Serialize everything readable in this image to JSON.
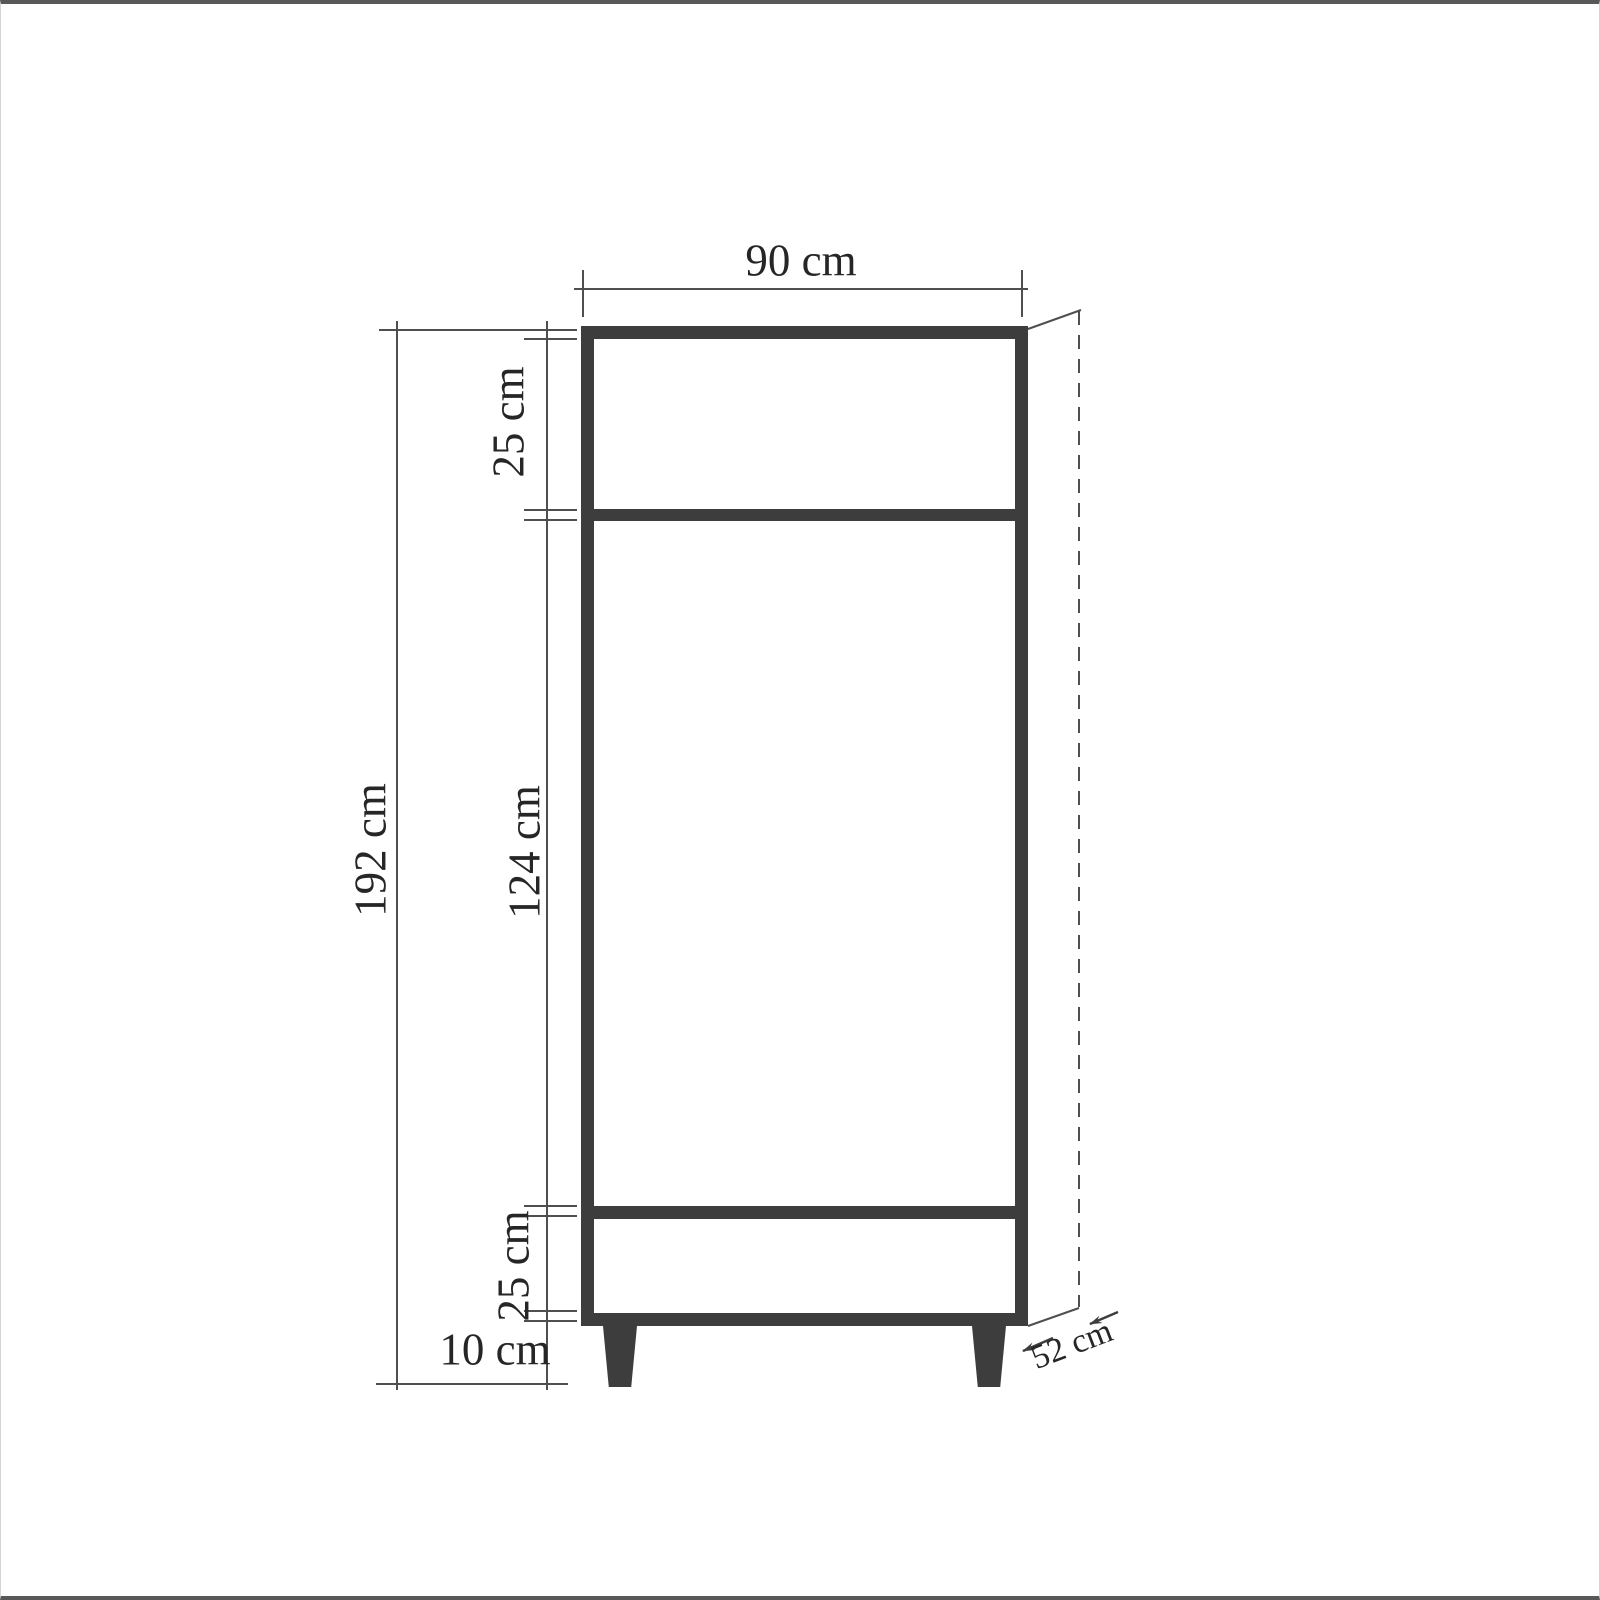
{
  "diagram": {
    "type": "furniture-dimension-drawing",
    "item": "two-door wardrobe front elevation",
    "colors": {
      "line": "#4f4f4f",
      "carcass_fill": "#3d3d3d",
      "rail_fill": "#9b9b9b",
      "text": "#262626",
      "background": "#ffffff"
    },
    "dimensions": {
      "width_top": "90 cm",
      "upper_section_height": "25 cm",
      "middle_section_height": "124 cm",
      "total_height": "192 cm",
      "drawer_section_height": "25 cm",
      "leg_height": "10 cm",
      "depth": "52 cm"
    }
  }
}
